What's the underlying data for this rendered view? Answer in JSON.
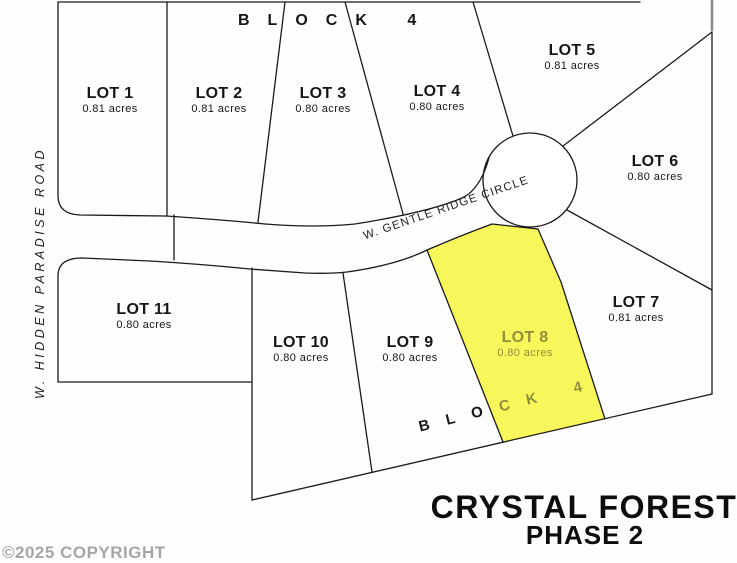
{
  "plat": {
    "block_label_top": "BLOCK 4",
    "block_label_bottom": {
      "white_part": "BLO",
      "highlight_part": "CK 4"
    },
    "roads": {
      "hidden_paradise": "W. HIDDEN PARADISE ROAD",
      "gentle_ridge": "W. GENTLE RIDGE CIRCLE"
    },
    "lots": [
      {
        "name": "LOT 1",
        "acres": "0.81 acres",
        "highlighted": false
      },
      {
        "name": "LOT 2",
        "acres": "0.81 acres",
        "highlighted": false
      },
      {
        "name": "LOT 3",
        "acres": "0.80 acres",
        "highlighted": false
      },
      {
        "name": "LOT 4",
        "acres": "0.80 acres",
        "highlighted": false
      },
      {
        "name": "LOT 5",
        "acres": "0.81 acres",
        "highlighted": false
      },
      {
        "name": "LOT 6",
        "acres": "0.80 acres",
        "highlighted": false
      },
      {
        "name": "LOT 7",
        "acres": "0.81 acres",
        "highlighted": false
      },
      {
        "name": "LOT 8",
        "acres": "0.80 acres",
        "highlighted": true
      },
      {
        "name": "LOT 9",
        "acres": "0.80 acres",
        "highlighted": false
      },
      {
        "name": "LOT 10",
        "acres": "0.80 acres",
        "highlighted": false
      },
      {
        "name": "LOT 11",
        "acres": "0.80 acres",
        "highlighted": false
      }
    ],
    "title": {
      "main": "CRYSTAL FOREST",
      "phase": "PHASE 2"
    },
    "copyright": "©2025 COPYRIGHT",
    "colors": {
      "highlight": "#F7F75C",
      "highlight_text": "#8F8F3C",
      "line": "#1a1a1a",
      "background": "#FFFFFF",
      "copyright_text": "#A6A6A6"
    }
  }
}
